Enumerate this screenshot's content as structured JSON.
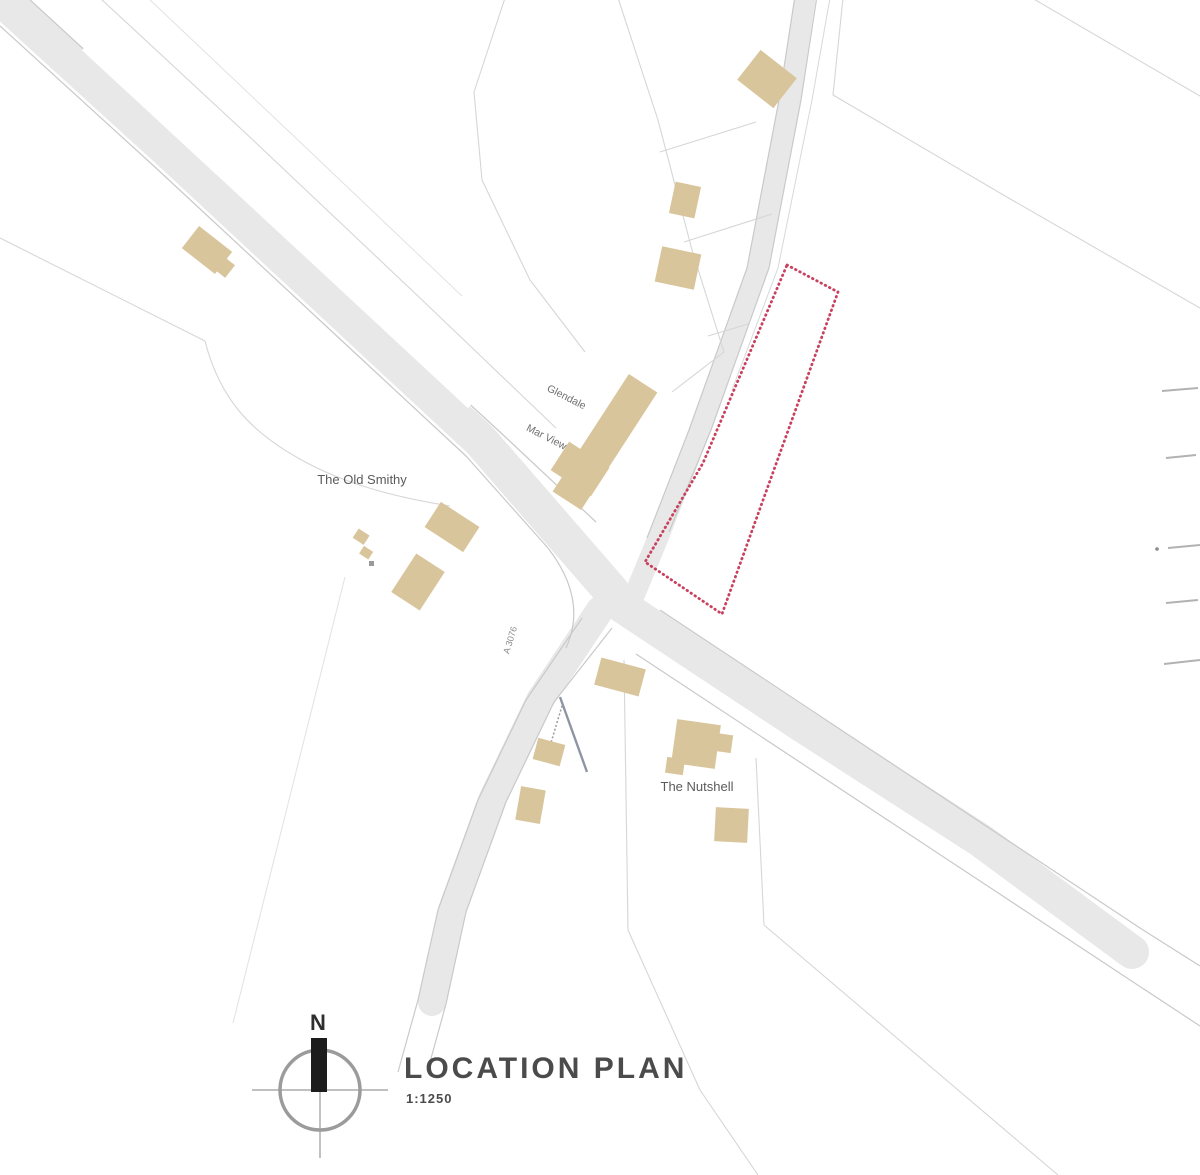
{
  "theme": {
    "page_bg": "#ffffff",
    "road_fill": "#e8e8e8",
    "road_casing": "#c9c9c9",
    "parcel_line": "#d6d6d6",
    "parcel_line_faint": "#e2e2e2",
    "building_fill": "#d9c59c",
    "building_accent": "#9a9a9a",
    "site_outline": "#c8415e",
    "track_line": "#8f96a3",
    "edge_mark": "#b2b2b2",
    "compass_ring": "#9b9b9b",
    "compass_needle": "#1c1c1c",
    "title_text": "#4b4b4b",
    "label_text": "#5a5a5a",
    "label_text_light": "#6f6f6f",
    "road_label_text": "#8a8a8a"
  },
  "title_block": {
    "heading": "LOCATION PLAN",
    "scale": "1:1250"
  },
  "compass": {
    "north_label": "N"
  },
  "map_labels": {
    "property_left": "The Old Smithy",
    "property_center_upper": "Glendale",
    "property_center_lower": "Mar View",
    "property_south": "The Nutshell",
    "road_designation": "A 3076"
  }
}
